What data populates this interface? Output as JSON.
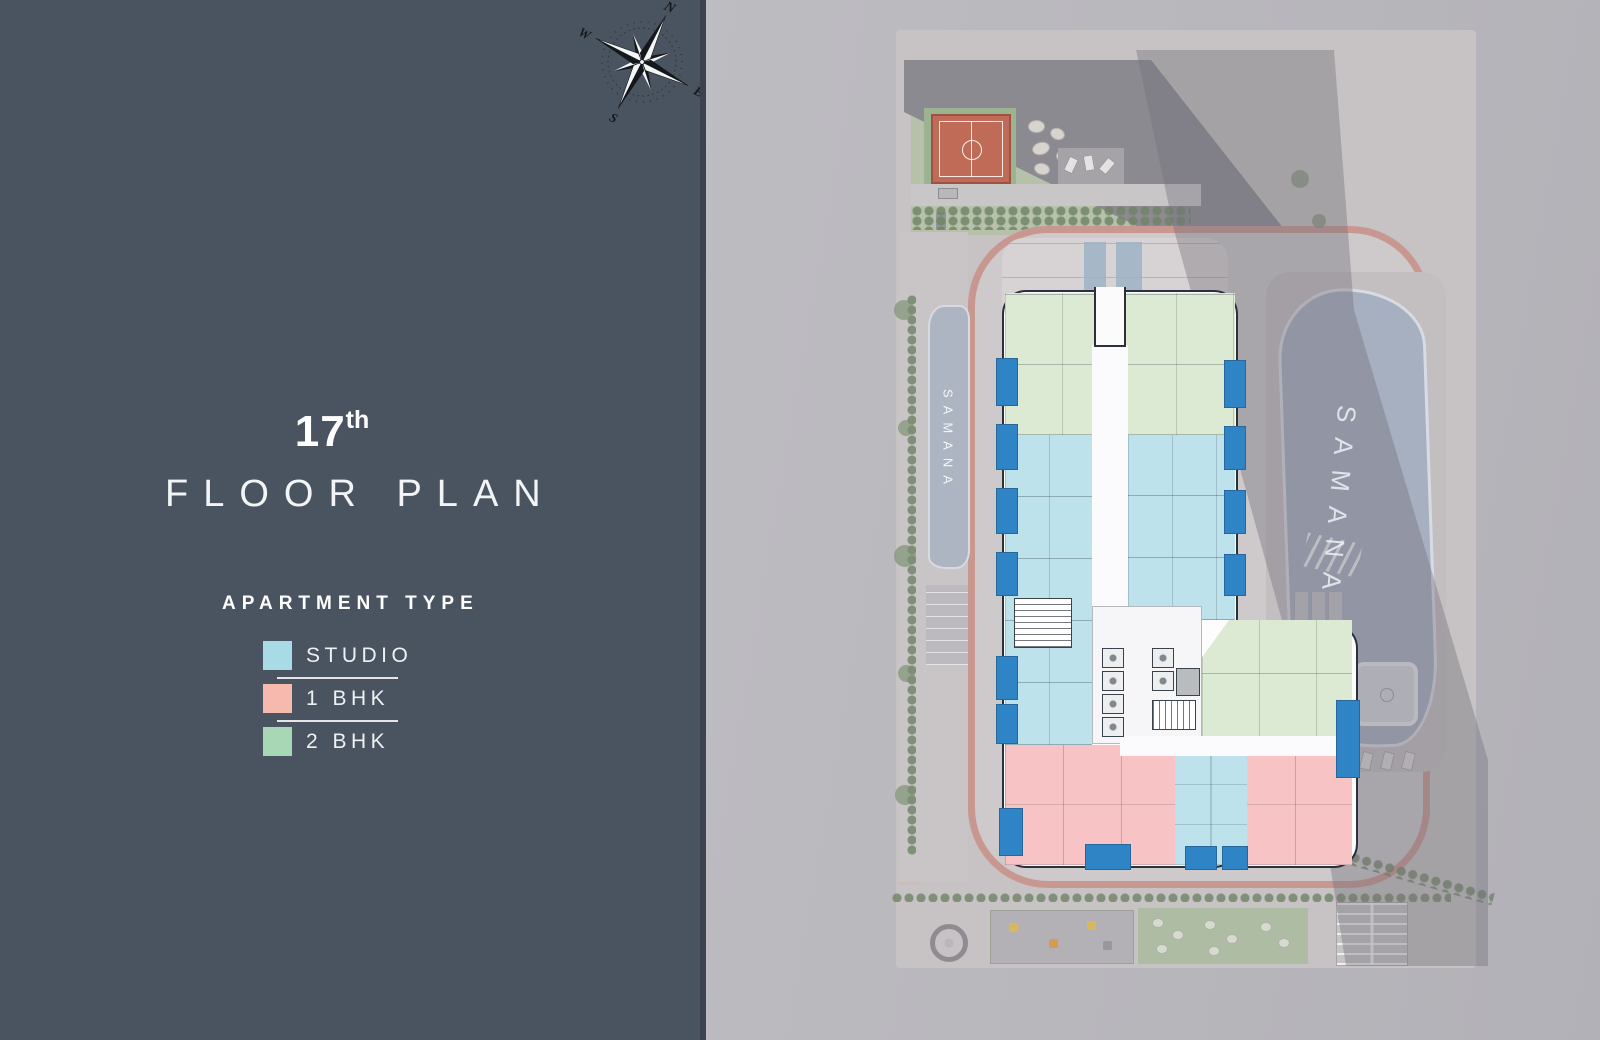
{
  "left_panel": {
    "floor_number": "17",
    "floor_ordinal_suffix": "th",
    "title": "FLOOR PLAN",
    "apartment_type_heading": "APARTMENT TYPE",
    "legend": [
      {
        "label": "STUDIO",
        "color": "#a7dbe6"
      },
      {
        "label": "1 BHK",
        "color": "#f5b9ae"
      },
      {
        "label": "2 BHK",
        "color": "#a7d7b4"
      }
    ],
    "compass": {
      "north": "N",
      "east": "E",
      "south": "S",
      "west": "W"
    },
    "panel_color": "#4a5460"
  },
  "site_plan": {
    "river_label": "SAMANA",
    "pool_label": "SAMANA",
    "unit_colors": {
      "studio_fill": "#bee2ec",
      "one_bhk_fill": "#f7c3c5",
      "two_bhk_fill": "#dcead3",
      "balcony_fill": "#2f84c5"
    },
    "site_colors": {
      "track": "#c57a68",
      "basketball_court": "#c06a58",
      "pool_water": "#a7b0c0",
      "landscape_green": "#a9bb9e"
    }
  }
}
